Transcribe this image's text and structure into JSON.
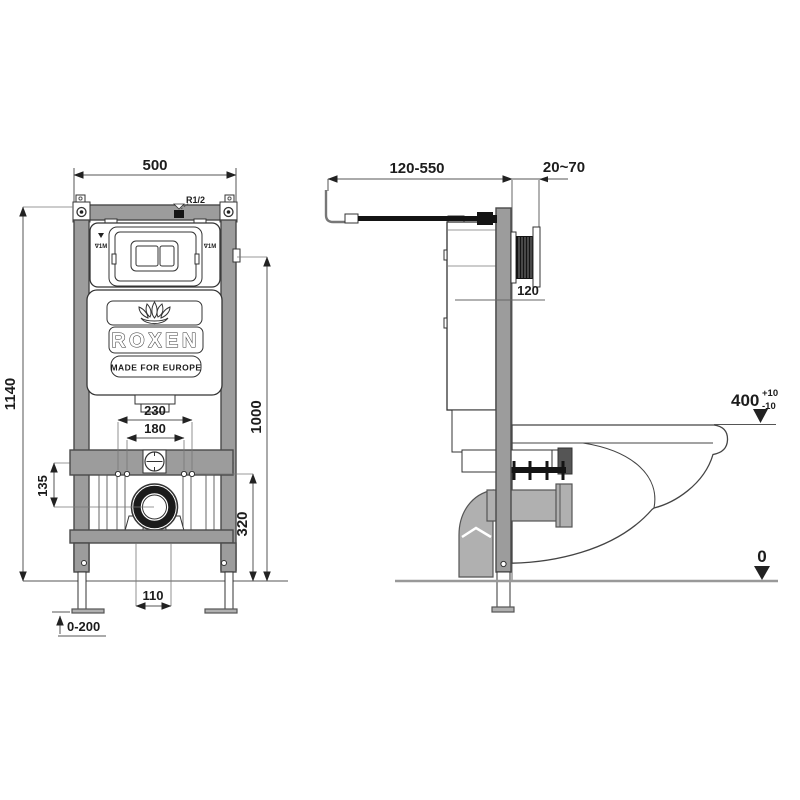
{
  "drawing_title": "Wall-hung toilet concealed cistern installation frame - dimensional drawing",
  "colors": {
    "background": "#ffffff",
    "line": "#3a3a3a",
    "frame_gray": "#9c9c9c",
    "pipe_gray": "#b0b0b0",
    "black_parts": "#141414"
  },
  "front": {
    "dim_width": "500",
    "dim_height": "1140",
    "dim_flush_height": "1000",
    "dim_drain_height": "320",
    "dim_bolt_spacing_outer": "230",
    "dim_bolt_spacing_inner": "180",
    "dim_flush_to_drain": "135",
    "dim_outlet_offset": "110",
    "dim_leg_adjust": "0-200",
    "label_inlet": "R1/2",
    "label_water_level_left": "∇1M",
    "label_water_level_right": "∇1M",
    "logo_brand": "ROXEN",
    "logo_tagline": "MADE FOR EUROPE"
  },
  "side": {
    "dim_inlet_reach": "120-550",
    "dim_wall_thickness": "20~70",
    "dim_frame_depth": "120",
    "dim_bowl_height": "400",
    "tol_plus": "+10",
    "tol_minus": "-10",
    "floor_level": "0"
  }
}
